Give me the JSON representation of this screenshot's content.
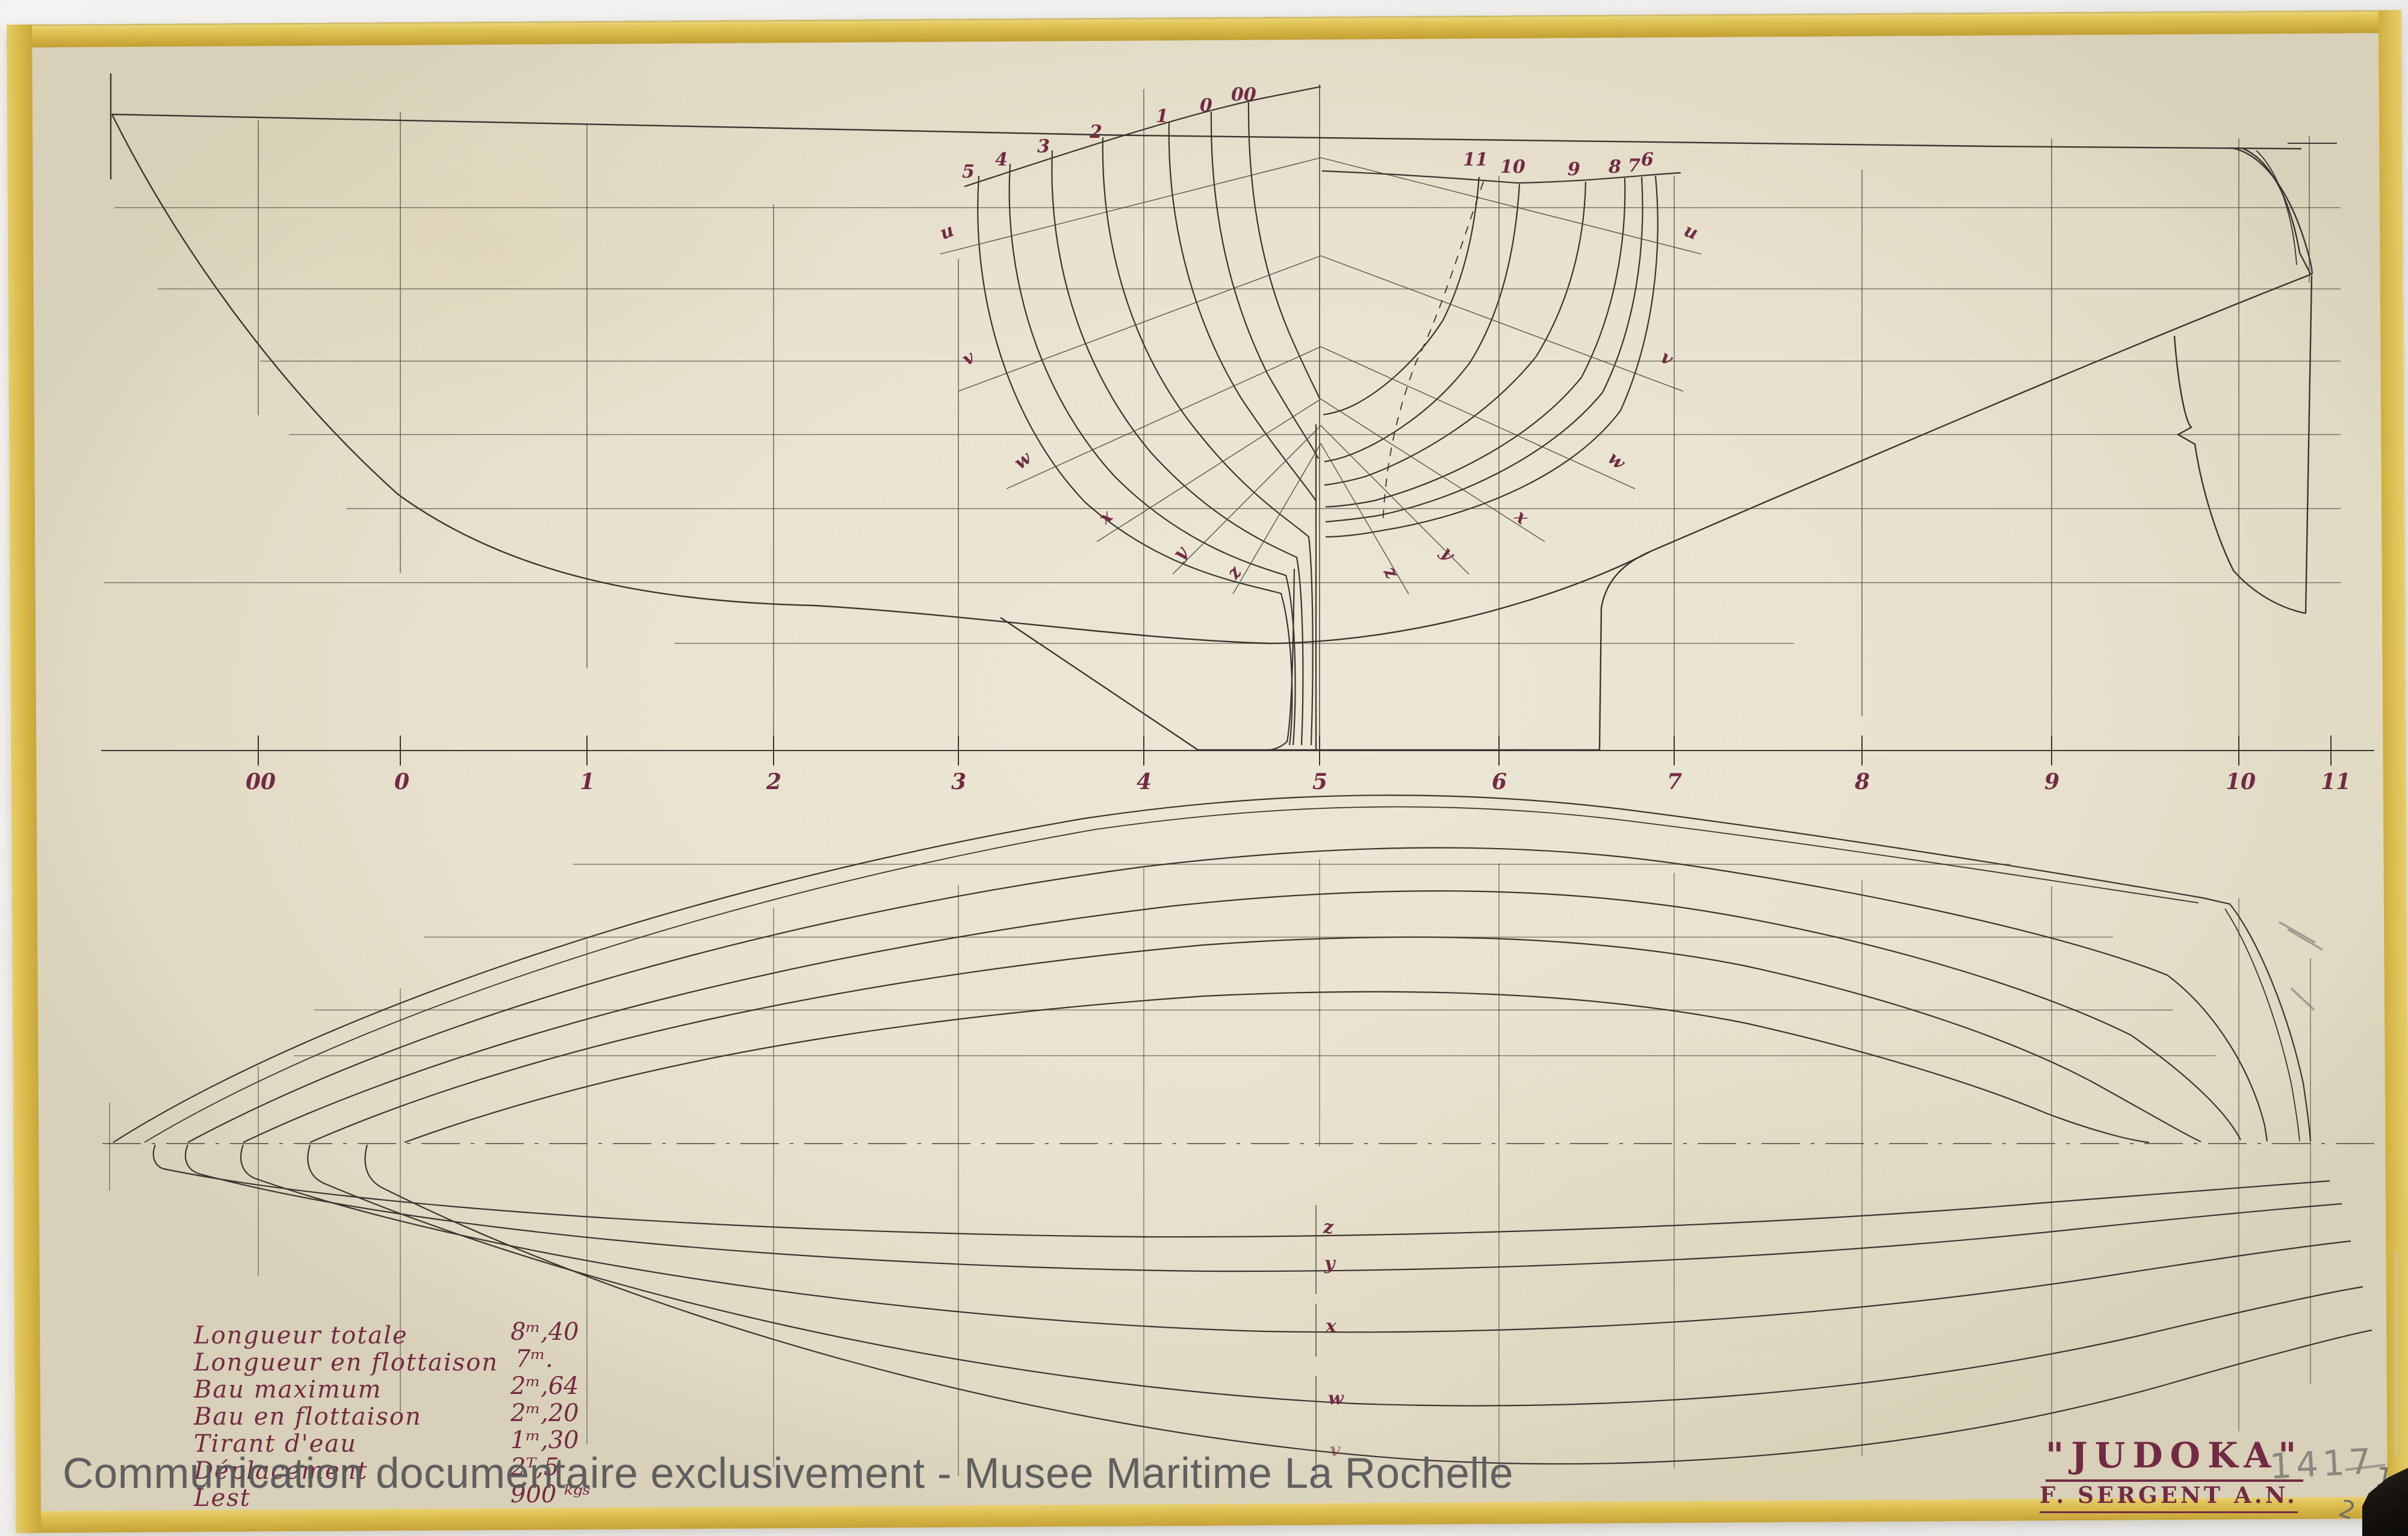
{
  "document": {
    "watermark": "Communication documentaire exclusivement - Musee Maritime La Rochelle",
    "title": "\"JUDOKA\"",
    "author": "F. SERGENT A.N.",
    "drawing_number": "1417",
    "pencil_mark_right_edge": "1",
    "pencil_mark_bottom_tape": "2"
  },
  "specs": {
    "rows": [
      {
        "label": "Longueur totale",
        "value": "8ᵐ,40"
      },
      {
        "label": "Longueur en flottaison",
        "value": "7ᵐ."
      },
      {
        "label": "Bau maximum",
        "value": "2ᵐ,64"
      },
      {
        "label": "Bau en flottaison",
        "value": "2ᵐ,20"
      },
      {
        "label": "Tirant d'eau",
        "value": "1ᵐ,30"
      },
      {
        "label": "Déplacement",
        "value": "2ᵀ,5"
      },
      {
        "label": "Lest",
        "value": "900 ᵏᵍˢ"
      }
    ]
  },
  "stations": {
    "labels": [
      "00",
      "0",
      "1",
      "2",
      "3",
      "4",
      "5",
      "6",
      "7",
      "8",
      "9",
      "10",
      "11"
    ]
  },
  "body_plan": {
    "fore_sections": [
      "5",
      "4",
      "3",
      "2",
      "1",
      "0",
      "00"
    ],
    "aft_sections": [
      "11",
      "10",
      "9",
      "8",
      "7",
      "6"
    ],
    "diagonals_left": [
      "u",
      "v",
      "w",
      "x",
      "y",
      "z"
    ],
    "diagonals_right": [
      "u",
      "v",
      "w",
      "x",
      "y",
      "z"
    ]
  },
  "half_breadth": {
    "diagonals": [
      "z",
      "y",
      "x",
      "w",
      "v"
    ]
  },
  "colors": {
    "ink_line": "#3b3531",
    "red_ink": "#722a44",
    "paper": "#e8e2cf",
    "tape": "#d8ba4c",
    "pencil": "#8a8781",
    "watermark_gray": "#595a5c"
  }
}
